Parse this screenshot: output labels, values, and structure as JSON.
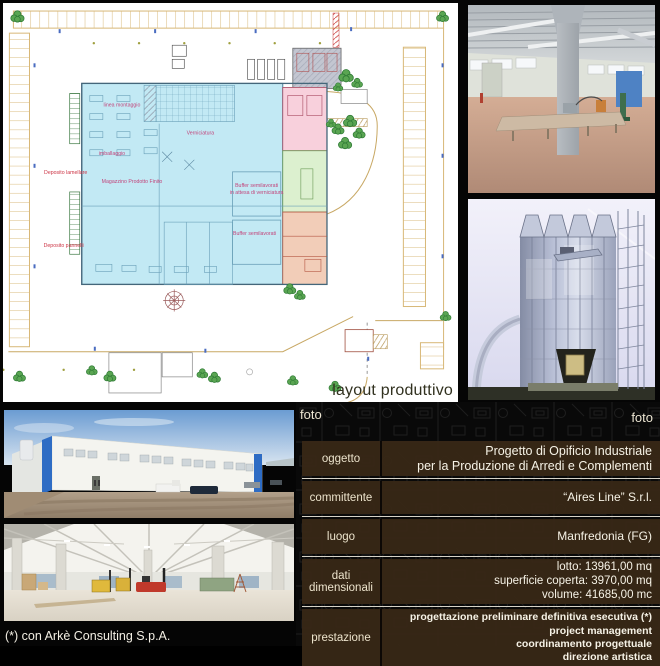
{
  "plan": {
    "caption": "layout produttivo",
    "zone_labels": {
      "linea_montaggio": "linea montaggio",
      "verniciatura": "Verniciatura",
      "imballaggio": "imballaggio",
      "magazzino": "Magazzino Prodotto Finito",
      "buffer1_line1": "Buffer semilavorati",
      "buffer1_line2": "in attesa di verniciatura",
      "buffer2": "Buffer semilavorati",
      "deposito_lamellare": "Deposito lamellare",
      "deposito_pannelli": "Deposito pannelli"
    },
    "colors": {
      "building": "#c2e9f4",
      "paint_zone": "#f8d0dc",
      "green_zone": "#dcf0cf",
      "services_zone": "#f2cdb8",
      "site_lines": "#d8b878"
    }
  },
  "photos": {
    "label": "foto"
  },
  "info_table": {
    "rows": [
      {
        "label": "oggetto",
        "lines": [
          "Progetto di Opificio Industriale",
          "per la Produzione di Arredi e Complementi"
        ]
      },
      {
        "label": "committente",
        "lines": [
          "“Aires Line” S.r.l."
        ]
      },
      {
        "label": "luogo",
        "lines": [
          "Manfredonia (FG)"
        ]
      },
      {
        "label": "dati dimensionali",
        "lines": [
          "lotto: 13961,00 mq",
          "superficie coperta: 3970,00 mq",
          "volume: 41685,00 mc"
        ]
      },
      {
        "label": "prestazione",
        "lines": [
          "progettazione preliminare definitiva esecutiva (*)",
          "project management",
          "coordinamento progettuale",
          "direzione artistica"
        ]
      }
    ]
  },
  "footer": {
    "credit": "(*) con Arkè Consulting S.p.A."
  }
}
